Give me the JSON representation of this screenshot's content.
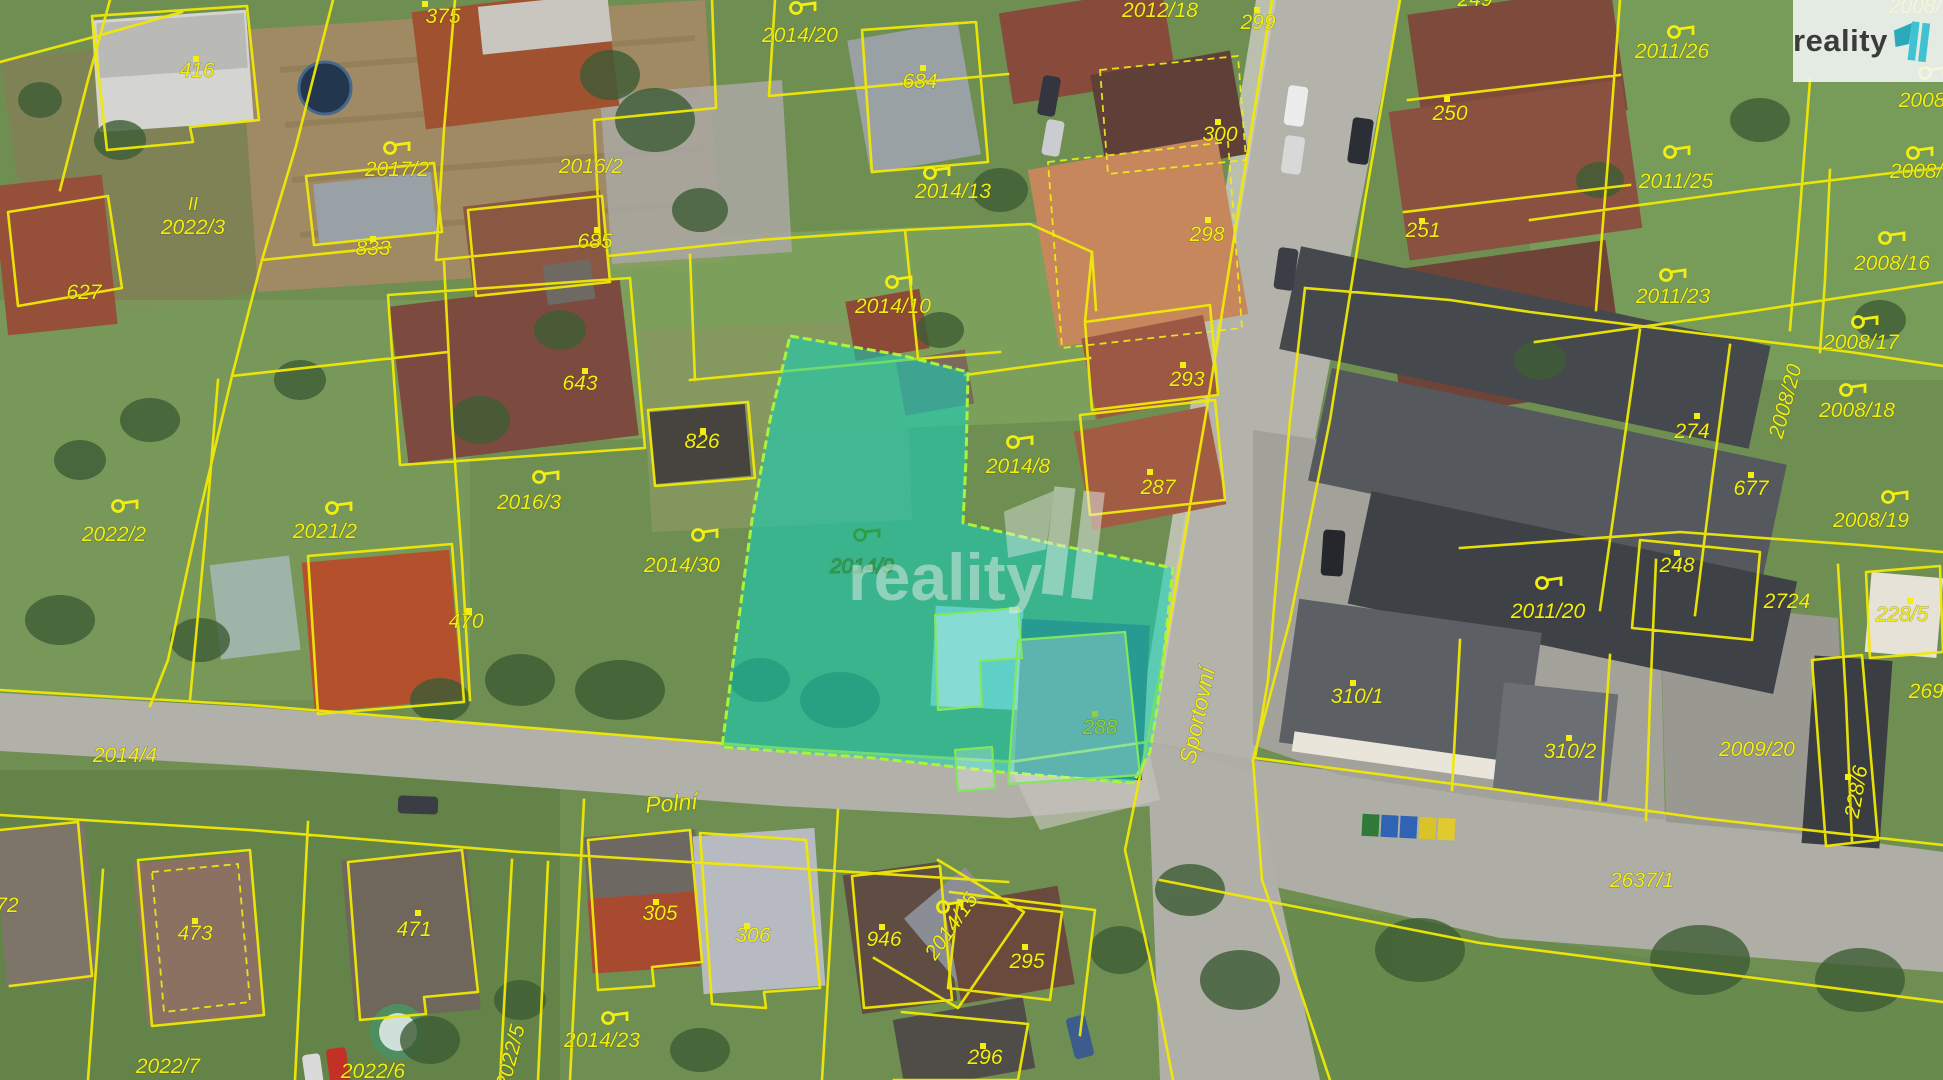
{
  "app": {
    "type": "cadastral-aerial-map"
  },
  "logo": {
    "brand": "reality",
    "accent_color": "#3fc3d2",
    "flag_color": "#2aa9bd"
  },
  "watermark": {
    "text": "reality"
  },
  "highlight": {
    "parcel": "2014/9",
    "fill_color": "#14d2bd",
    "outline_color": "#aaf23c"
  },
  "streets": [
    {
      "name": "Polní"
    },
    {
      "name": "Sportovní"
    }
  ],
  "label_colors": {
    "y": "#f2ee12",
    "g": "#2f9e44",
    "l": "#8fd03c"
  },
  "labels": [
    {
      "t": "416",
      "x": 197,
      "y": 77
    },
    {
      "t": "375",
      "x": 443,
      "y": 23
    },
    {
      "t": "2017/2",
      "x": 397,
      "y": 176
    },
    {
      "t": "2022/3",
      "x": 193,
      "y": 234
    },
    {
      "t": "833",
      "x": 373,
      "y": 255
    },
    {
      "t": "627",
      "x": 84,
      "y": 299
    },
    {
      "t": "II",
      "x": 193,
      "y": 210,
      "s": 18
    },
    {
      "t": "2016/2",
      "x": 591,
      "y": 173
    },
    {
      "t": "685",
      "x": 595,
      "y": 248
    },
    {
      "t": "2014/20",
      "x": 800,
      "y": 42
    },
    {
      "t": "684",
      "x": 920,
      "y": 88
    },
    {
      "t": "2014/13",
      "x": 953,
      "y": 198
    },
    {
      "t": "2012/18",
      "x": 1160,
      "y": 17
    },
    {
      "t": "299",
      "x": 1258,
      "y": 29
    },
    {
      "t": "300",
      "x": 1220,
      "y": 141
    },
    {
      "t": "298",
      "x": 1207,
      "y": 241
    },
    {
      "t": "249",
      "x": 1475,
      "y": 6
    },
    {
      "t": "250",
      "x": 1450,
      "y": 120
    },
    {
      "t": "251",
      "x": 1423,
      "y": 237
    },
    {
      "t": "2011/26",
      "x": 1672,
      "y": 58
    },
    {
      "t": "2011/25",
      "x": 1676,
      "y": 188
    },
    {
      "t": "2011/23",
      "x": 1673,
      "y": 303
    },
    {
      "t": "2008/1",
      "x": 1921,
      "y": 13
    },
    {
      "t": "2008/",
      "x": 1925,
      "y": 107
    },
    {
      "t": "2008/1",
      "x": 1922,
      "y": 178
    },
    {
      "t": "2008/16",
      "x": 1892,
      "y": 270
    },
    {
      "t": "2008/17",
      "x": 1861,
      "y": 349
    },
    {
      "t": "2008/18",
      "x": 1857,
      "y": 417
    },
    {
      "t": "2008/19",
      "x": 1871,
      "y": 527
    },
    {
      "t": "2008/20",
      "x": 1792,
      "y": 403,
      "r": -75
    },
    {
      "t": "274",
      "x": 1692,
      "y": 438
    },
    {
      "t": "677",
      "x": 1751,
      "y": 495
    },
    {
      "t": "248",
      "x": 1677,
      "y": 572
    },
    {
      "t": "2011/20",
      "x": 1548,
      "y": 618
    },
    {
      "t": "2724",
      "x": 1787,
      "y": 608
    },
    {
      "t": "228/5",
      "x": 1902,
      "y": 621
    },
    {
      "t": "2691",
      "x": 1932,
      "y": 698
    },
    {
      "t": "310/1",
      "x": 1357,
      "y": 703
    },
    {
      "t": "310/2",
      "x": 1570,
      "y": 758
    },
    {
      "t": "2009/20",
      "x": 1757,
      "y": 756
    },
    {
      "t": "228/6",
      "x": 1863,
      "y": 793,
      "r": -80
    },
    {
      "t": "2637/1",
      "x": 1642,
      "y": 887
    },
    {
      "t": "643",
      "x": 580,
      "y": 390
    },
    {
      "t": "826",
      "x": 702,
      "y": 448
    },
    {
      "t": "2016/3",
      "x": 529,
      "y": 509
    },
    {
      "t": "2021/2",
      "x": 325,
      "y": 538
    },
    {
      "t": "2022/2",
      "x": 114,
      "y": 541
    },
    {
      "t": "2014/30",
      "x": 682,
      "y": 572
    },
    {
      "t": "2014/9",
      "x": 862,
      "y": 573,
      "c": "g"
    },
    {
      "t": "470",
      "x": 466,
      "y": 628
    },
    {
      "t": "2014/10",
      "x": 893,
      "y": 313
    },
    {
      "t": "2014/8",
      "x": 1018,
      "y": 473
    },
    {
      "t": "287",
      "x": 1158,
      "y": 494
    },
    {
      "t": "293",
      "x": 1187,
      "y": 386
    },
    {
      "t": "288",
      "x": 1100,
      "y": 734,
      "c": "l"
    },
    {
      "t": "Sportovní",
      "x": 1205,
      "y": 717,
      "r": -78,
      "s": 23,
      "street": true
    },
    {
      "t": "Polní",
      "x": 672,
      "y": 811,
      "r": -4,
      "s": 23,
      "street": true
    },
    {
      "t": "2014/4",
      "x": 125,
      "y": 762
    },
    {
      "t": "473",
      "x": 195,
      "y": 940
    },
    {
      "t": "471",
      "x": 414,
      "y": 936
    },
    {
      "t": "72",
      "x": 7,
      "y": 912
    },
    {
      "t": "2022/7",
      "x": 168,
      "y": 1073
    },
    {
      "t": "2022/6",
      "x": 373,
      "y": 1078
    },
    {
      "t": "2022/5",
      "x": 517,
      "y": 1058,
      "r": -76
    },
    {
      "t": "2014/23",
      "x": 602,
      "y": 1047
    },
    {
      "t": "305",
      "x": 660,
      "y": 920
    },
    {
      "t": "306",
      "x": 753,
      "y": 942
    },
    {
      "t": "946",
      "x": 884,
      "y": 946
    },
    {
      "t": "2014/15",
      "x": 957,
      "y": 930,
      "r": -55
    },
    {
      "t": "295",
      "x": 1027,
      "y": 968
    },
    {
      "t": "296",
      "x": 985,
      "y": 1064
    }
  ],
  "flags": [
    {
      "x": 390,
      "y": 148
    },
    {
      "x": 796,
      "y": 8
    },
    {
      "x": 930,
      "y": 173
    },
    {
      "x": 892,
      "y": 282
    },
    {
      "x": 1013,
      "y": 442
    },
    {
      "x": 698,
      "y": 535
    },
    {
      "x": 539,
      "y": 477
    },
    {
      "x": 332,
      "y": 508
    },
    {
      "x": 118,
      "y": 506
    },
    {
      "x": 1674,
      "y": 32
    },
    {
      "x": 1670,
      "y": 152
    },
    {
      "x": 1666,
      "y": 275
    },
    {
      "x": 1885,
      "y": 238
    },
    {
      "x": 1858,
      "y": 322
    },
    {
      "x": 1846,
      "y": 390
    },
    {
      "x": 1888,
      "y": 497
    },
    {
      "x": 1542,
      "y": 583
    },
    {
      "x": 608,
      "y": 1018
    },
    {
      "x": 943,
      "y": 907
    },
    {
      "x": 1925,
      "y": 73
    },
    {
      "x": 1913,
      "y": 153
    },
    {
      "x": 860,
      "y": 535,
      "c": "g"
    }
  ],
  "dots": [
    {
      "x": 196,
      "y": 59
    },
    {
      "x": 425,
      "y": 4
    },
    {
      "x": 373,
      "y": 239
    },
    {
      "x": 597,
      "y": 230
    },
    {
      "x": 923,
      "y": 68
    },
    {
      "x": 1257,
      "y": 10
    },
    {
      "x": 1218,
      "y": 122
    },
    {
      "x": 1208,
      "y": 220
    },
    {
      "x": 1447,
      "y": 99
    },
    {
      "x": 1422,
      "y": 221
    },
    {
      "x": 585,
      "y": 371
    },
    {
      "x": 703,
      "y": 431
    },
    {
      "x": 469,
      "y": 611
    },
    {
      "x": 195,
      "y": 921
    },
    {
      "x": 418,
      "y": 913
    },
    {
      "x": 656,
      "y": 902
    },
    {
      "x": 747,
      "y": 926
    },
    {
      "x": 882,
      "y": 927
    },
    {
      "x": 1025,
      "y": 947
    },
    {
      "x": 983,
      "y": 1046
    },
    {
      "x": 1150,
      "y": 472
    },
    {
      "x": 1183,
      "y": 365
    },
    {
      "x": 1095,
      "y": 714,
      "c": "l"
    },
    {
      "x": 1353,
      "y": 683
    },
    {
      "x": 1569,
      "y": 738
    },
    {
      "x": 1677,
      "y": 553
    },
    {
      "x": 1697,
      "y": 416
    },
    {
      "x": 1751,
      "y": 475
    },
    {
      "x": 1910,
      "y": 601
    },
    {
      "x": 1848,
      "y": 777
    }
  ]
}
